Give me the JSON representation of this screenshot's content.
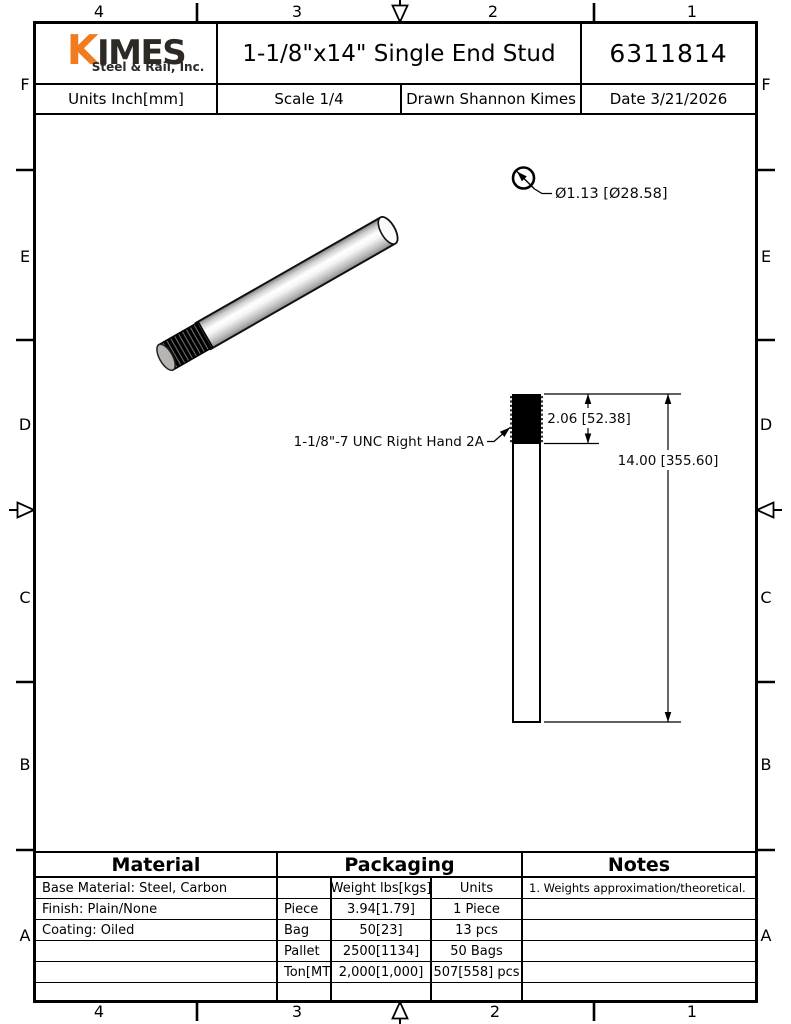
{
  "header": {
    "logo": {
      "k": "K",
      "imes": "IMES",
      "subtitle": "Steel & Rail, Inc."
    },
    "title": "1-1/8\"x14\" Single End Stud",
    "part_number": "6311814",
    "units": "Units Inch[mm]",
    "scale": "Scale 1/4",
    "drawn": "Drawn Shannon Kimes",
    "date": "Date 3/21/2026"
  },
  "zones": {
    "top": [
      "4",
      "3",
      "2",
      "1"
    ],
    "bottom": [
      "4",
      "3",
      "2",
      "1"
    ],
    "left": [
      "F",
      "E",
      "D",
      "C",
      "B",
      "A"
    ],
    "right": [
      "F",
      "E",
      "D",
      "C",
      "B",
      "A"
    ]
  },
  "drawing": {
    "diameter_label": "Ø1.13 [Ø28.58]",
    "thread_label": "1-1/8\"-7 UNC Right Hand 2A",
    "thread_length_label": "2.06 [52.38]",
    "overall_length_label": "14.00 [355.60]"
  },
  "tables": {
    "material": {
      "header": "Material",
      "rows": [
        "Base Material: Steel, Carbon",
        "Finish: Plain/None",
        "Coating: Oiled",
        "",
        "",
        ""
      ]
    },
    "packaging": {
      "header": "Packaging",
      "label_col": [
        "",
        "Piece",
        "Bag",
        "Pallet",
        "Ton[MT]",
        ""
      ],
      "weight_col": [
        "Weight lbs[kgs]",
        "3.94[1.79]",
        "50[23]",
        "2500[1134]",
        "2,000[1,000]",
        ""
      ],
      "units_col": [
        "Units",
        "1 Piece",
        "13 pcs",
        "50 Bags",
        "507[558] pcs",
        ""
      ]
    },
    "notes": {
      "header": "Notes",
      "rows": [
        "1. Weights approximation/theoretical.",
        "",
        "",
        "",
        "",
        ""
      ]
    }
  },
  "colors": {
    "logo_orange": "#F07C1F",
    "logo_dark": "#2D2A26",
    "line": "#000000"
  }
}
